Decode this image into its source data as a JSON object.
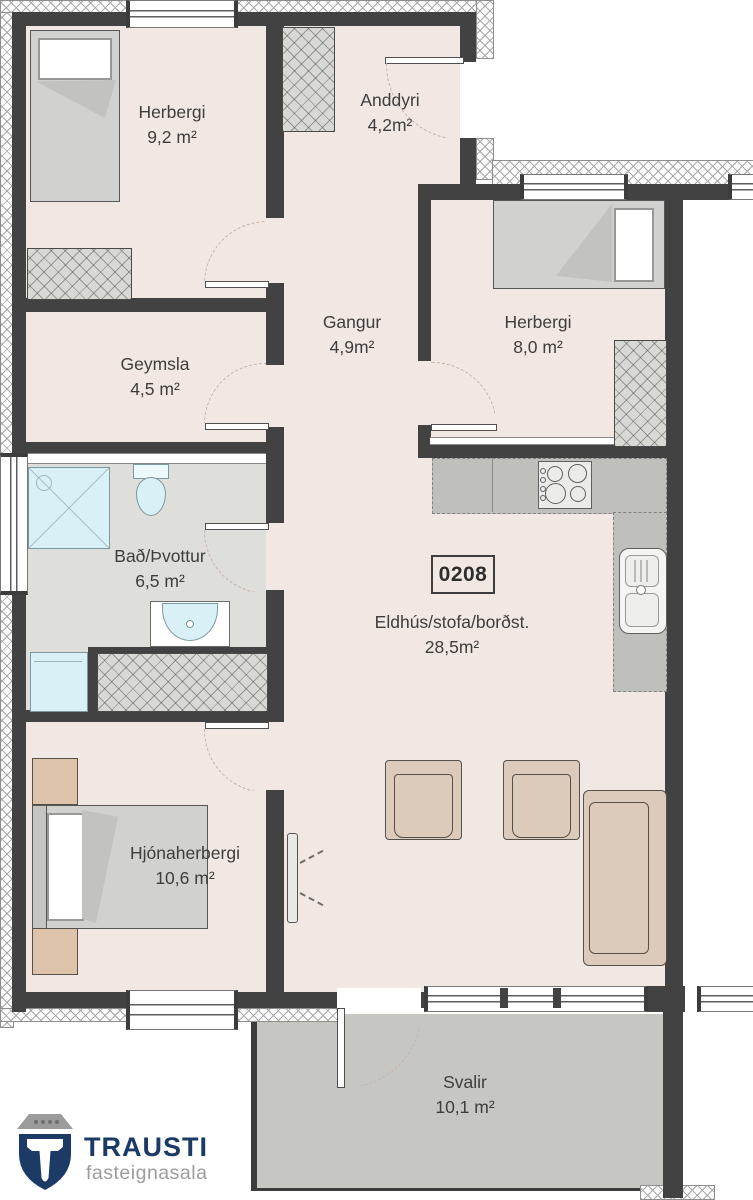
{
  "document": {
    "type": "floor-plan",
    "unit_number": "0208"
  },
  "rooms": {
    "herbergi1": {
      "name": "Herbergi",
      "area": "9,2 m²"
    },
    "anddyri": {
      "name": "Anddyri",
      "area": "4,2m²"
    },
    "herbergi2": {
      "name": "Herbergi",
      "area": "8,0 m²"
    },
    "gangur": {
      "name": "Gangur",
      "area": "4,9m²"
    },
    "geymsla": {
      "name": "Geymsla",
      "area": "4,5 m²"
    },
    "bad": {
      "name": "Bað/Þvottur",
      "area": "6,5 m²"
    },
    "eldhus": {
      "name": "Eldhús/stofa/borðst.",
      "area": "28,5m²"
    },
    "hjonaherbergi": {
      "name": "Hjónaherbergi",
      "area": "10,6 m²"
    },
    "svalir": {
      "name": "Svalir",
      "area": "10,1 m²"
    }
  },
  "logo": {
    "brand": "TRAUSTI",
    "tagline": "fasteignasala"
  },
  "colors": {
    "wall": "#424242",
    "floor": "#f2e8e3",
    "wet_room_floor": "#dededb",
    "balcony_floor": "#c6c7c3",
    "brand_navy": "#1c3a66",
    "brand_gray": "#9c9c9c"
  }
}
